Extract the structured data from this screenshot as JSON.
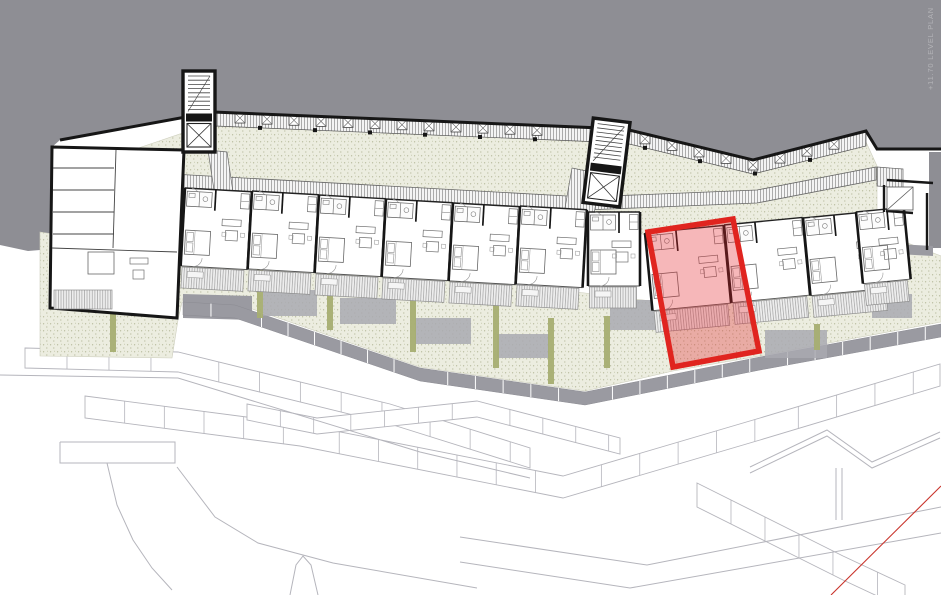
{
  "watermark": {
    "text": "+11.70 LEVEL PLAN"
  },
  "colors": {
    "background": "#ffffff",
    "hillside": "#8e8e94",
    "wall": "#161616",
    "line": "#3c3c3c",
    "furniture": "#8f8f8f",
    "garden": "#ecede0",
    "garden-dot": "#b6ba9b",
    "hedge": "#a6ae71",
    "paver": "#9a9aa1",
    "patio": "#a9a9b0",
    "terrain": "#b5b5bc",
    "highlight-fill": "#e3242b",
    "highlight-stroke": "#e0241f",
    "red-line": "#c9342c",
    "watermark": "#ffffff"
  },
  "plan": {
    "canvas": {
      "w": 941,
      "h": 595
    },
    "gray_area": [
      [
        0,
        0
      ],
      [
        941,
        0
      ],
      [
        941,
        149
      ],
      [
        877,
        149
      ],
      [
        866,
        131
      ],
      [
        753,
        160
      ],
      [
        625,
        129
      ],
      [
        213,
        112
      ],
      [
        60,
        140
      ],
      [
        52,
        147
      ],
      [
        52,
        249
      ],
      [
        28,
        251
      ],
      [
        0,
        245
      ]
    ],
    "gray_pocket": [
      [
        929,
        152
      ],
      [
        941,
        152
      ],
      [
        941,
        248
      ],
      [
        929,
        248
      ]
    ],
    "north_wall": [
      [
        60,
        140
      ],
      [
        213,
        112
      ],
      [
        625,
        129
      ],
      [
        753,
        160
      ],
      [
        866,
        131
      ],
      [
        877,
        149
      ],
      [
        941,
        149
      ]
    ],
    "north_band": [
      [
        215,
        112
      ],
      [
        625,
        129
      ],
      [
        753,
        160
      ],
      [
        866,
        132
      ],
      [
        866,
        146
      ],
      [
        753,
        174
      ],
      [
        625,
        143
      ],
      [
        215,
        126
      ]
    ],
    "band_mid": [
      [
        215,
        117
      ],
      [
        625,
        134
      ],
      [
        753,
        165
      ],
      [
        866,
        136
      ]
    ],
    "band_bottom": [
      [
        215,
        126
      ],
      [
        625,
        143
      ],
      [
        753,
        174
      ],
      [
        866,
        146
      ]
    ],
    "storage_boxes": {
      "x_start": 240,
      "x_end": 556,
      "x2_start": 645,
      "x2_end": 855,
      "step": 27
    },
    "garden_north": [
      [
        118,
        155
      ],
      [
        215,
        122
      ],
      [
        625,
        140
      ],
      [
        750,
        170
      ],
      [
        866,
        142
      ],
      [
        877,
        166
      ],
      [
        877,
        212
      ],
      [
        650,
        237
      ],
      [
        585,
        212
      ],
      [
        118,
        180
      ]
    ],
    "garden_south": [
      [
        40,
        232
      ],
      [
        160,
        250
      ],
      [
        560,
        290
      ],
      [
        660,
        302
      ],
      [
        905,
        242
      ],
      [
        941,
        256
      ],
      [
        941,
        322
      ],
      [
        760,
        356
      ],
      [
        673,
        371
      ],
      [
        585,
        391
      ],
      [
        420,
        367
      ],
      [
        235,
        303
      ],
      [
        183,
        298
      ],
      [
        178,
        320
      ],
      [
        172,
        358
      ],
      [
        40,
        356
      ]
    ],
    "corridor": {
      "pts": [
        [
          118,
          171
        ],
        [
          585,
          197
        ],
        [
          757,
          190
        ],
        [
          876,
          167
        ]
      ],
      "w": 13
    },
    "connectors": [
      [
        [
          208,
          150
        ],
        [
          227,
          152
        ],
        [
          233,
          192
        ],
        [
          214,
          190
        ]
      ],
      [
        [
          572,
          168
        ],
        [
          601,
          174
        ],
        [
          590,
          237
        ],
        [
          561,
          231
        ]
      ],
      [
        [
          877,
          167
        ],
        [
          903,
          169
        ],
        [
          903,
          188
        ],
        [
          877,
          186
        ]
      ]
    ],
    "paver_path": {
      "pts": [
        [
          183,
          302
        ],
        [
          235,
          305
        ],
        [
          420,
          368
        ],
        [
          585,
          392
        ],
        [
          760,
          357
        ],
        [
          941,
          324
        ]
      ],
      "w": 13,
      "seg": 28
    },
    "plaza": [
      [
        183,
        294
      ],
      [
        252,
        296
      ],
      [
        252,
        320
      ],
      [
        183,
        318
      ]
    ],
    "paver_strip": [
      [
        897,
        244
      ],
      [
        933,
        246
      ],
      [
        933,
        256
      ],
      [
        897,
        254
      ]
    ],
    "patios": [
      [
        263,
        290,
        54,
        26
      ],
      [
        340,
        298,
        56,
        26
      ],
      [
        415,
        318,
        56,
        26
      ],
      [
        497,
        334,
        52,
        24
      ],
      [
        610,
        300,
        46,
        30
      ],
      [
        765,
        330,
        62,
        28
      ],
      [
        872,
        294,
        40,
        24
      ]
    ],
    "hedges": [
      [
        113,
        304,
        352
      ],
      [
        260,
        262,
        318
      ],
      [
        330,
        268,
        330
      ],
      [
        413,
        288,
        352
      ],
      [
        496,
        300,
        368
      ],
      [
        551,
        318,
        384
      ],
      [
        607,
        316,
        368
      ],
      [
        817,
        324,
        350
      ]
    ],
    "left_block": {
      "outline": [
        [
          52,
          147
        ],
        [
          184,
          150
        ],
        [
          177,
          318
        ],
        [
          50,
          308
        ]
      ],
      "room_lines": [
        [
          [
            53,
            168
          ],
          [
            114,
            168
          ]
        ],
        [
          [
            53,
            190
          ],
          [
            114,
            190
          ]
        ],
        [
          [
            53,
            212
          ],
          [
            114,
            212
          ]
        ],
        [
          [
            53,
            234
          ],
          [
            114,
            234
          ]
        ],
        [
          [
            116,
            150
          ],
          [
            113,
            248
          ]
        ],
        [
          [
            52,
            248
          ],
          [
            177,
            252
          ]
        ]
      ],
      "deck": [
        54,
        290,
        58,
        19
      ]
    },
    "towers": [
      {
        "x": 183,
        "y": 71,
        "w": 32,
        "h": 81,
        "r": 0
      },
      {
        "x": 588,
        "y": 120,
        "w": 37,
        "h": 85,
        "r": 7
      }
    ],
    "units": [
      {
        "x": 185,
        "y": 188,
        "w": 67,
        "h": 78,
        "a": 3.2
      },
      {
        "x": 252,
        "y": 191,
        "w": 67,
        "h": 78,
        "a": 3.2
      },
      {
        "x": 319,
        "y": 195,
        "w": 67,
        "h": 78,
        "a": 3.2
      },
      {
        "x": 386,
        "y": 199,
        "w": 67,
        "h": 78,
        "a": 3.2
      },
      {
        "x": 453,
        "y": 203,
        "w": 67,
        "h": 78,
        "a": 3.2
      },
      {
        "x": 520,
        "y": 206,
        "w": 67,
        "h": 78,
        "a": 3.2
      },
      {
        "x": 588,
        "y": 212,
        "w": 52,
        "h": 74,
        "a": 0
      },
      {
        "x": 645,
        "y": 233,
        "w": 79,
        "h": 78,
        "a": -5.5
      },
      {
        "x": 724,
        "y": 225,
        "w": 79,
        "h": 78,
        "a": -5.5
      },
      {
        "x": 803,
        "y": 218,
        "w": 79,
        "h": 78,
        "a": -5.5
      },
      {
        "x": 856,
        "y": 212,
        "w": 48,
        "h": 72,
        "a": -5.5
      }
    ],
    "right_end": {
      "walls": [
        [
          [
            887,
            180
          ],
          [
            933,
            183
          ]
        ],
        [
          [
            884,
            185
          ],
          [
            884,
            212
          ]
        ],
        [
          [
            886,
            211
          ],
          [
            913,
            213
          ]
        ],
        [
          [
            927,
            193
          ],
          [
            927,
            250
          ]
        ]
      ],
      "stair_box": [
        887,
        187,
        26,
        23
      ]
    },
    "highlight": {
      "points": [
        [
          648,
          232
        ],
        [
          733,
          219
        ],
        [
          759,
          351
        ],
        [
          673,
          367
        ]
      ]
    },
    "red_line": [
      [
        831,
        595
      ],
      [
        941,
        486
      ]
    ],
    "terrain": {
      "bands": [
        {
          "pts": [
            [
              85,
              396
            ],
            [
              300,
              424
            ],
            [
              563,
              476
            ],
            [
              760,
              418
            ],
            [
              940,
              364
            ]
          ],
          "w": 22,
          "step": 40
        },
        {
          "pts": [
            [
              25,
              348
            ],
            [
              178,
              352
            ],
            [
              390,
              404
            ],
            [
              530,
              448
            ]
          ],
          "w": 20,
          "step": 42
        },
        {
          "pts": [
            [
              247,
              404
            ],
            [
              317,
              418
            ],
            [
              477,
              401
            ],
            [
              620,
              438
            ]
          ],
          "w": 16,
          "step": 34
        },
        {
          "pts": [
            [
              697,
              483
            ],
            [
              843,
              556
            ],
            [
              905,
              585
            ]
          ],
          "w": 24,
          "step": 38
        }
      ],
      "lines": [
        [
          [
            0,
            375
          ],
          [
            178,
            378
          ],
          [
            420,
            452
          ],
          [
            530,
            478
          ]
        ],
        [
          [
            107,
            463
          ],
          [
            117,
            505
          ],
          [
            133,
            540
          ],
          [
            152,
            568
          ],
          [
            172,
            590
          ]
        ],
        [
          [
            177,
            467
          ],
          [
            215,
            517
          ],
          [
            258,
            543
          ],
          [
            333,
            563
          ],
          [
            477,
            588
          ]
        ],
        [
          [
            460,
            537
          ],
          [
            647,
            565
          ],
          [
            941,
            507
          ]
        ],
        [
          [
            460,
            562
          ],
          [
            630,
            588
          ],
          [
            941,
            533
          ]
        ],
        [
          [
            750,
            467
          ],
          [
            827,
            430
          ],
          [
            872,
            462
          ],
          [
            940,
            432
          ]
        ],
        [
          [
            750,
            473
          ],
          [
            827,
            436
          ],
          [
            872,
            468
          ],
          [
            940,
            438
          ]
        ],
        [
          [
            836,
            468
          ],
          [
            836,
            520
          ]
        ],
        [
          [
            842,
            468
          ],
          [
            842,
            520
          ]
        ],
        [
          [
            290,
            595
          ],
          [
            296,
            565
          ],
          [
            303,
            556
          ],
          [
            311,
            565
          ],
          [
            318,
            595
          ]
        ],
        [
          [
            60,
            442
          ],
          [
            175,
            442
          ],
          [
            175,
            463
          ],
          [
            60,
            463
          ],
          [
            60,
            442
          ]
        ]
      ]
    }
  }
}
